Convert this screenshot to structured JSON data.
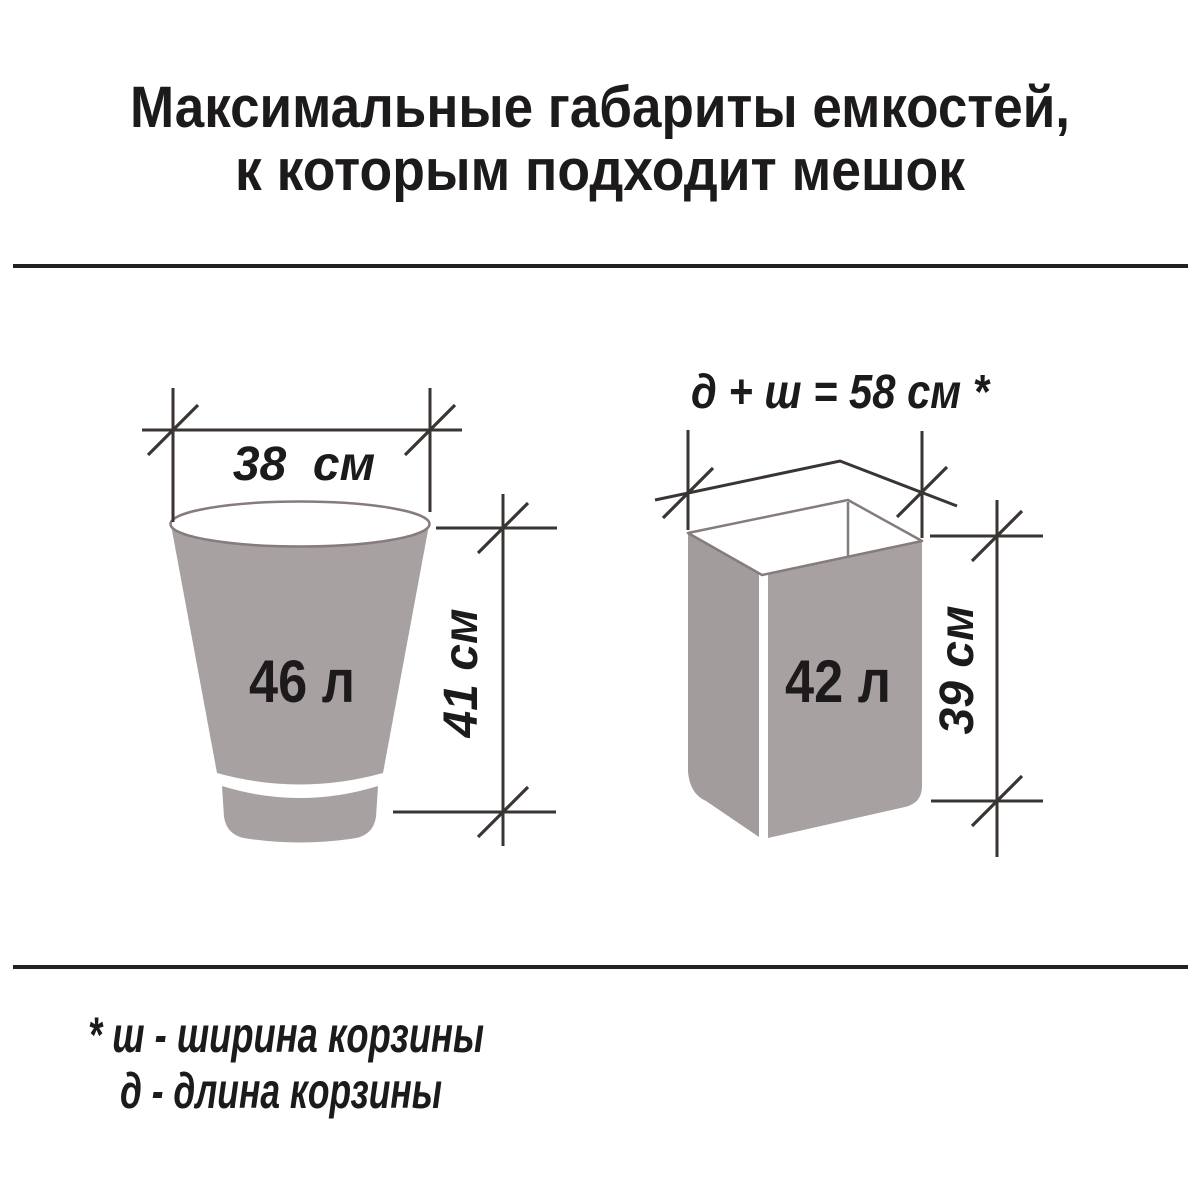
{
  "title": {
    "line1": "Максимальные габариты емкостей,",
    "line2": "к которым подходит мешок"
  },
  "bucket": {
    "volume_label": "46 л",
    "width_label": "38  см",
    "height_label": "41 см"
  },
  "box": {
    "volume_label": "42 л",
    "perimeter_label": "д + ш = 58 см *",
    "height_label": "39 см"
  },
  "footnote": {
    "line1": "* ш - ширина корзины",
    "line2": "д  - длина корзины"
  },
  "colors": {
    "container_fill": "#a7a1a1",
    "container_fill_dark": "#a29c9c",
    "container_outline": "#857c7b",
    "dimension_line": "#3a3433",
    "rule": "#242020",
    "text": "#1c1a1a"
  }
}
